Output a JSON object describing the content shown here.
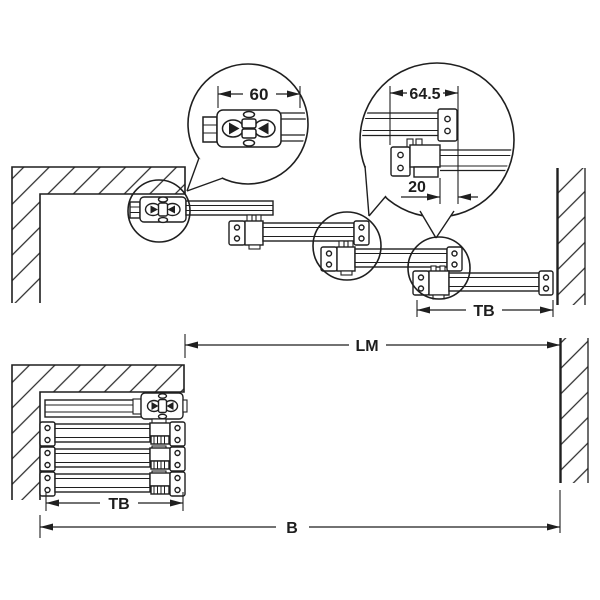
{
  "diagram": {
    "kind": "technical-installation-drawing",
    "detail_circles": {
      "left": {
        "dimension": "60"
      },
      "right": {
        "dimension_top": "64.5",
        "dimension_bottom": "20"
      }
    },
    "dimensions": {
      "top_rail": "TB",
      "clear_opening": "LM",
      "bottom_rail": "TB",
      "overall": "B"
    },
    "colors": {
      "line": "#1f1f1f",
      "hatch": "#2a2a2a",
      "background": "#ffffff"
    }
  }
}
